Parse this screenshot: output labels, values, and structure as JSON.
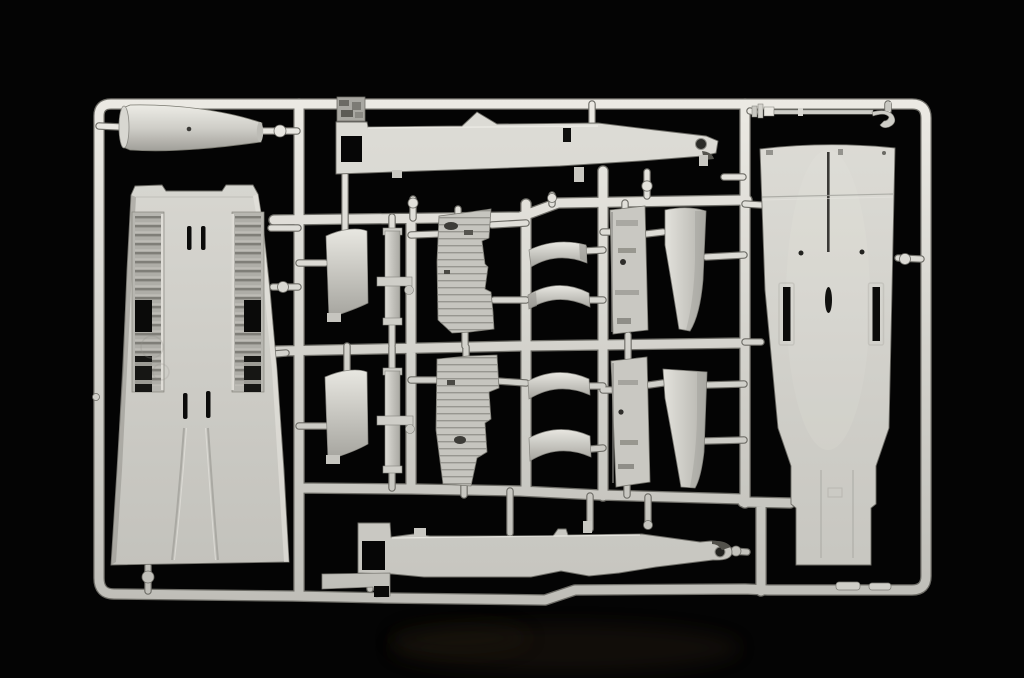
{
  "scene": {
    "description": "Studio photograph of a light-grey injection-molded plastic model kit sprue (parts tree) with aircraft fuselage, wing and intake parts, on a black background",
    "colors": {
      "background": "#040404",
      "plastic_base": "#d4d3cd",
      "plastic_highlight": "#eceae4",
      "plastic_mid": "#c6c5bf",
      "plastic_shadow": "#a09f99",
      "plastic_edge": "#75746d",
      "recess_dark": "#141412",
      "hole_black": "#0a0a09",
      "smudge_brown": "#2e2317"
    },
    "parts": [
      {
        "id": "sprue-frame",
        "label": "Sprue frame and runner grid"
      },
      {
        "id": "drop-tank-half",
        "label": "Molded part - tapered tank/duct half"
      },
      {
        "id": "wing-fuselage-panel",
        "label": "Molded part - large upper fuselage-wing panel with gear bays"
      },
      {
        "id": "fuselage-spine-upper",
        "label": "Molded part - long fuselage side strip, upper"
      },
      {
        "id": "detail-block",
        "label": "Molded part - small textured detail block"
      },
      {
        "id": "airbrake-door-upper",
        "label": "Molded part - curved door panel, upper"
      },
      {
        "id": "airbrake-door-lower",
        "label": "Molded part - curved door panel, lower"
      },
      {
        "id": "actuator-strut-upper",
        "label": "Molded part - thin actuator strut, upper"
      },
      {
        "id": "actuator-strut-lower",
        "label": "Molded part - thin actuator strut, lower"
      },
      {
        "id": "bay-wall-panel-upper",
        "label": "Molded part - ribbed bay wall panel, upper"
      },
      {
        "id": "bay-wall-panel-lower",
        "label": "Molded part - ribbed bay wall panel, lower"
      },
      {
        "id": "intake-lip-1",
        "label": "Molded part - curved intake lip 1"
      },
      {
        "id": "intake-lip-2",
        "label": "Molded part - curved intake lip 2"
      },
      {
        "id": "intake-lip-3",
        "label": "Molded part - curved intake lip 3"
      },
      {
        "id": "intake-lip-4",
        "label": "Molded part - curved intake lip 4"
      },
      {
        "id": "avionics-panel-upper",
        "label": "Molded part - mottled side panel, upper"
      },
      {
        "id": "avionics-panel-lower",
        "label": "Molded part - mottled side panel, lower"
      },
      {
        "id": "intake-blade-upper",
        "label": "Molded part - curved intake splitter blade, upper"
      },
      {
        "id": "intake-blade-lower",
        "label": "Molded part - curved intake splitter blade, lower"
      },
      {
        "id": "lower-fuselage-panel",
        "label": "Molded part - large lower fuselage panel"
      },
      {
        "id": "pitot-probe",
        "label": "Molded part - thin probe rod with hooked end"
      },
      {
        "id": "fuselage-spine-lower",
        "label": "Molded part - long fuselage side strip, lower"
      },
      {
        "id": "mounting-plate",
        "label": "Molded part - small flat plate"
      }
    ]
  }
}
